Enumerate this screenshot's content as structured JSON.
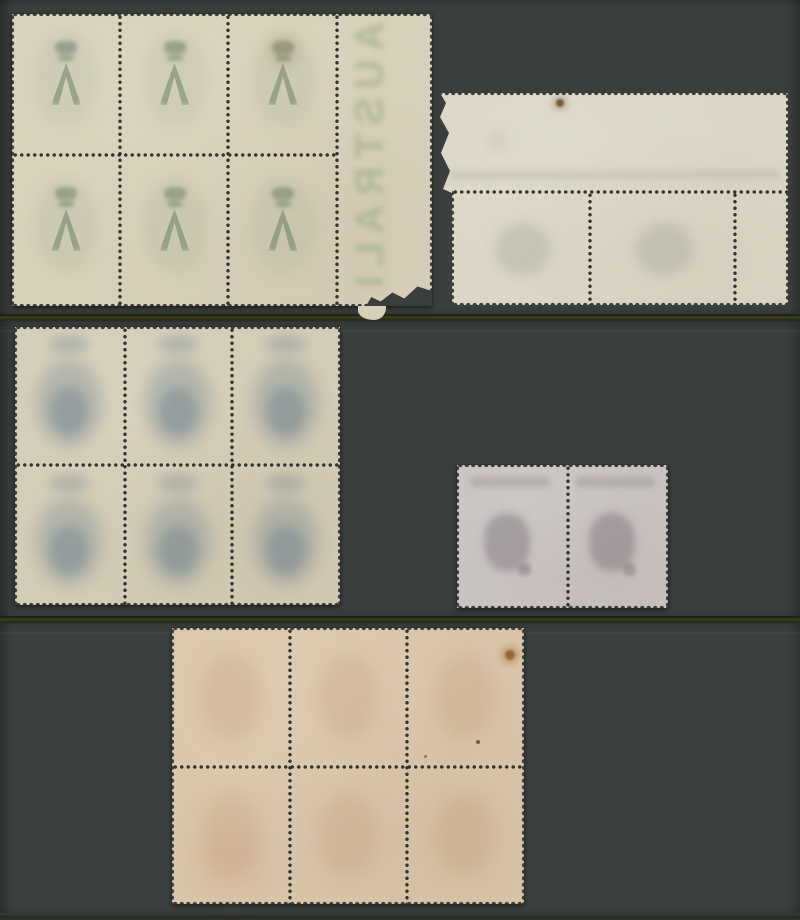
{
  "meta": {
    "title": "Photograph of five mint stamp multiples shown gum side up on dark grey card strips",
    "item_count": 5
  },
  "canvas": {
    "width": 800,
    "height": 920,
    "background": "#3a3e3c"
  },
  "strips": [
    {
      "y": 0,
      "h": 314,
      "bg": "#3a3e3c"
    },
    {
      "y": 320,
      "h": 296,
      "bg": "#393e3d"
    },
    {
      "y": 622,
      "h": 291,
      "bg": "#3b403f"
    }
  ],
  "dividers": [
    {
      "y": 314,
      "h": 7
    },
    {
      "y": 616,
      "h": 7
    }
  ],
  "bottom_band": {
    "y": 913,
    "h": 7
  },
  "dot_color": "rgba(40,45,40,0.95)",
  "pieces": [
    {
      "id": "stamp-block-six-cream-with-selvedge",
      "label": "Block of 6 stamps, gum side, cream paper, right sheet margin with torn corner",
      "x": 12,
      "y": 14,
      "w": 420,
      "h": 292,
      "paper": "#d7d0ba",
      "bg": "#3a3e3c",
      "grid": {
        "cols": 3,
        "rows": 2,
        "x0": 0,
        "y0": 0,
        "w": 325,
        "h": 292
      },
      "motif": {
        "style": "crown-a",
        "color": "rgba(96,122,100,0.50)",
        "wash": "rgba(140,160,140,0.14)"
      },
      "perf_v": [
        {
          "x": 108
        },
        {
          "x": 216
        },
        {
          "x": 325
        }
      ],
      "perf_h": [
        {
          "y": 141,
          "x0": 0,
          "x1": 325
        }
      ],
      "selvedge_text": {
        "text": "AUSTRALIA",
        "x": 336,
        "w": 72,
        "color": "rgba(110,150,115,0.38)"
      },
      "stains": [
        {
          "x": 272,
          "y": 38,
          "r": 16,
          "color": "rgba(150,110,60,0.16)",
          "blur": 5
        }
      ],
      "tail": {
        "x": 346,
        "y": 288,
        "w": 28,
        "h": 18
      },
      "tears": [
        {
          "x": 354,
          "y": 262,
          "w": 66,
          "h": 30,
          "clip": "0% 100%, 8% 70%, 22% 85%, 40% 55%, 58% 75%, 78% 35%, 100% 50%, 100% 100%"
        }
      ]
    },
    {
      "id": "stamp-corner-margin-pair",
      "label": "Top-right corner piece, pair of stamps with wide blank top margin, torn at left",
      "x": 437,
      "y": 93,
      "w": 351,
      "h": 212,
      "paper": "#dbd6c6",
      "bg": "#3a3e3c",
      "clip": "3px 0px, 351px 0px, 351px 212px, 15px 212px, 15px 100px, 6px 96px, 13px 78px, 4px 60px, 12px 40px, 3px 24px, 9px 10px",
      "grid": {
        "cols": 2,
        "rows": 1,
        "x0": 15,
        "y0": 99,
        "w": 283,
        "h": 113
      },
      "motif": {
        "style": "mottle-gray",
        "color": "rgba(148,156,142,0.30)"
      },
      "perf_v": [
        {
          "x": 153,
          "y0": 99,
          "y1": 212
        },
        {
          "x": 298,
          "y0": 99,
          "y1": 212
        }
      ],
      "perf_h": [
        {
          "y": 99,
          "x0": 15,
          "x1": 351
        }
      ],
      "streak": {
        "x": 12,
        "y": 78,
        "w": 332,
        "h": 8,
        "color": "rgba(150,168,145,0.30)"
      },
      "stains": [
        {
          "x": 123,
          "y": 10,
          "r": 4,
          "color": "rgba(95,66,30,0.85)",
          "blur": 1
        },
        {
          "x": 123,
          "y": 10,
          "r": 8,
          "color": "rgba(130,95,50,0.25)",
          "blur": 3
        },
        {
          "x": 60,
          "y": 48,
          "r": 10,
          "color": "rgba(150,120,80,0.10)",
          "blur": 5
        }
      ],
      "edges": [
        {
          "side": "top",
          "x": 0,
          "y": 0,
          "len": 351
        },
        {
          "side": "right",
          "x": 347,
          "y": 0,
          "len": 212
        },
        {
          "side": "bottom",
          "x": 15,
          "y": 208,
          "len": 336
        },
        {
          "side": "left",
          "x": 0,
          "y": 0,
          "len": 97
        },
        {
          "side": "left",
          "x": 15,
          "y": 97,
          "len": 115
        }
      ]
    },
    {
      "id": "stamp-block-six-blue-showthrough",
      "label": "Block of 6 stamps, gum side, blue design showing through",
      "x": 15,
      "y": 327,
      "w": 325,
      "h": 278,
      "paper": "#d3ccb6",
      "bg": "#393e3d",
      "grid": {
        "cols": 3,
        "rows": 2,
        "x0": 0,
        "y0": 0,
        "w": 325,
        "h": 278
      },
      "motif": {
        "style": "mottle-blue",
        "color": "rgba(100,124,140,0.30)",
        "core": "rgba(72,100,124,0.28)"
      },
      "perf_v": [
        {
          "x": 110
        },
        {
          "x": 217
        }
      ],
      "perf_h": [
        {
          "y": 138,
          "x0": 0,
          "x1": 325
        }
      ],
      "stains": []
    },
    {
      "id": "stamp-pair-grey-lilac-kangaroo",
      "label": "Horizontal pair of kangaroo stamps, gum side, grey-lilac",
      "x": 457,
      "y": 465,
      "w": 211,
      "h": 143,
      "paper": "#c8c2c0",
      "bg": "#393e3d",
      "grid": {
        "cols": 2,
        "rows": 1,
        "x0": 0,
        "y0": 0,
        "w": 211,
        "h": 143
      },
      "motif": {
        "style": "kangaroo",
        "color": "rgba(118,108,120,0.45)",
        "band": "rgba(125,115,125,0.30)"
      },
      "perf_v": [
        {
          "x": 111
        }
      ],
      "perf_h": [],
      "stains": []
    },
    {
      "id": "stamp-block-six-buff",
      "label": "Block of 6 stamps, gum side, buff-pink paper with rust stain at top right",
      "x": 172,
      "y": 628,
      "w": 352,
      "h": 276,
      "paper": "#d9c5a9",
      "bg": "#3b403f",
      "grid": {
        "cols": 3,
        "rows": 2,
        "x0": 0,
        "y0": 0,
        "w": 352,
        "h": 276
      },
      "motif": {
        "style": "mottle-warm",
        "color": "rgba(175,130,95,0.18)"
      },
      "perf_v": [
        {
          "x": 118
        },
        {
          "x": 235
        }
      ],
      "perf_h": [
        {
          "y": 139,
          "x0": 0,
          "x1": 352
        }
      ],
      "stains": [
        {
          "x": 338,
          "y": 27,
          "r": 5,
          "color": "rgba(140,77,28,0.80)",
          "blur": 1
        },
        {
          "x": 338,
          "y": 27,
          "r": 10,
          "color": "rgba(150,95,40,0.28)",
          "blur": 3
        },
        {
          "x": 306,
          "y": 114,
          "r": 2,
          "color": "rgba(70,45,20,0.70)",
          "blur": 0
        },
        {
          "x": 253,
          "y": 128,
          "r": 1.5,
          "color": "rgba(70,45,20,0.50)",
          "blur": 0
        },
        {
          "x": 60,
          "y": 240,
          "r": 34,
          "color": "rgba(205,125,95,0.10)",
          "blur": 10
        }
      ]
    }
  ]
}
